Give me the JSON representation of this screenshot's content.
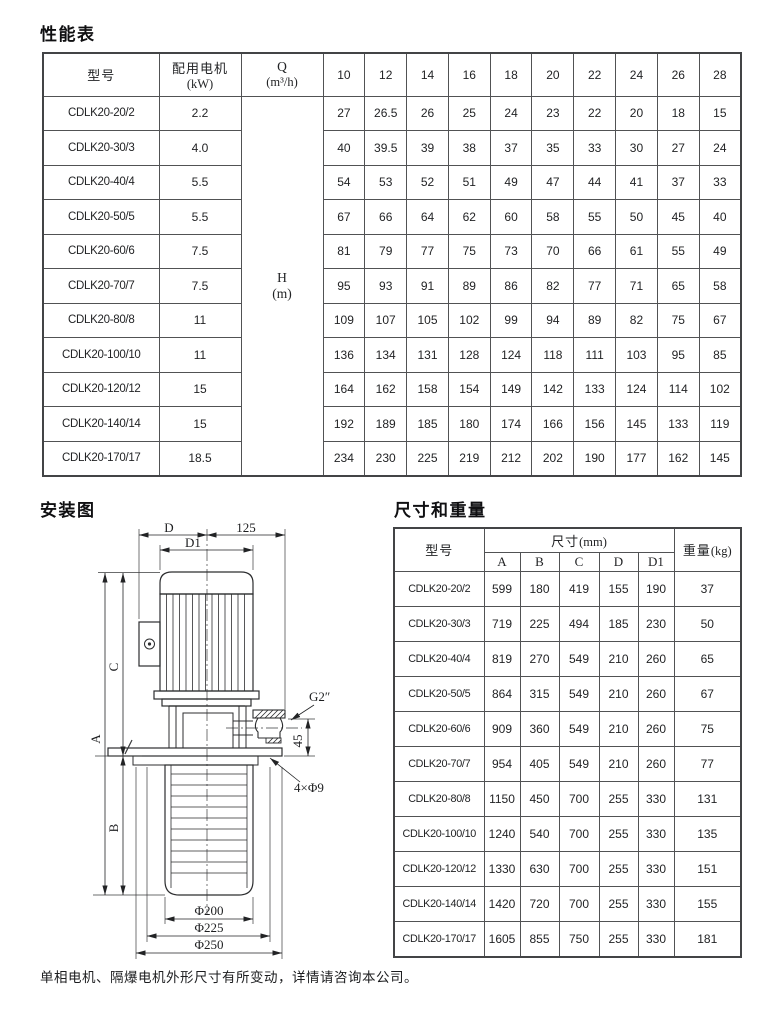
{
  "page": {
    "performance_title": "性能表",
    "installation_title": "安装图",
    "dimensions_title": "尺寸和重量",
    "footer_note": "单相电机、隔爆电机外形尺寸有所变动，详情请咨询本公司。"
  },
  "performance_table": {
    "col_model": "型号",
    "col_motor": "配用电机",
    "col_motor_unit": "(kW)",
    "col_q": "Q",
    "col_q_unit": "(m³/h)",
    "h_label": "H",
    "h_unit": "(m)",
    "flow_headers": [
      "10",
      "12",
      "14",
      "16",
      "18",
      "20",
      "22",
      "24",
      "26",
      "28"
    ],
    "rows": [
      {
        "model": "CDLK20-20/2",
        "kw": "2.2",
        "h": [
          "27",
          "26.5",
          "26",
          "25",
          "24",
          "23",
          "22",
          "20",
          "18",
          "15"
        ]
      },
      {
        "model": "CDLK20-30/3",
        "kw": "4.0",
        "h": [
          "40",
          "39.5",
          "39",
          "38",
          "37",
          "35",
          "33",
          "30",
          "27",
          "24"
        ]
      },
      {
        "model": "CDLK20-40/4",
        "kw": "5.5",
        "h": [
          "54",
          "53",
          "52",
          "51",
          "49",
          "47",
          "44",
          "41",
          "37",
          "33"
        ]
      },
      {
        "model": "CDLK20-50/5",
        "kw": "5.5",
        "h": [
          "67",
          "66",
          "64",
          "62",
          "60",
          "58",
          "55",
          "50",
          "45",
          "40"
        ]
      },
      {
        "model": "CDLK20-60/6",
        "kw": "7.5",
        "h": [
          "81",
          "79",
          "77",
          "75",
          "73",
          "70",
          "66",
          "61",
          "55",
          "49"
        ]
      },
      {
        "model": "CDLK20-70/7",
        "kw": "7.5",
        "h": [
          "95",
          "93",
          "91",
          "89",
          "86",
          "82",
          "77",
          "71",
          "65",
          "58"
        ]
      },
      {
        "model": "CDLK20-80/8",
        "kw": "11",
        "h": [
          "109",
          "107",
          "105",
          "102",
          "99",
          "94",
          "89",
          "82",
          "75",
          "67"
        ]
      },
      {
        "model": "CDLK20-100/10",
        "kw": "11",
        "h": [
          "136",
          "134",
          "131",
          "128",
          "124",
          "118",
          "111",
          "103",
          "95",
          "85"
        ]
      },
      {
        "model": "CDLK20-120/12",
        "kw": "15",
        "h": [
          "164",
          "162",
          "158",
          "154",
          "149",
          "142",
          "133",
          "124",
          "114",
          "102"
        ]
      },
      {
        "model": "CDLK20-140/14",
        "kw": "15",
        "h": [
          "192",
          "189",
          "185",
          "180",
          "174",
          "166",
          "156",
          "145",
          "133",
          "119"
        ]
      },
      {
        "model": "CDLK20-170/17",
        "kw": "18.5",
        "h": [
          "234",
          "230",
          "225",
          "219",
          "212",
          "202",
          "190",
          "177",
          "162",
          "145"
        ]
      }
    ]
  },
  "dimension_table": {
    "col_model": "型号",
    "col_dims": "尺寸",
    "col_dims_unit": "(mm)",
    "col_weight": "重量",
    "col_weight_unit": "(kg)",
    "dim_headers": [
      "A",
      "B",
      "C",
      "D",
      "D1"
    ],
    "rows": [
      {
        "model": "CDLK20-20/2",
        "dims": [
          "599",
          "180",
          "419",
          "155",
          "190"
        ],
        "weight": "37"
      },
      {
        "model": "CDLK20-30/3",
        "dims": [
          "719",
          "225",
          "494",
          "185",
          "230"
        ],
        "weight": "50"
      },
      {
        "model": "CDLK20-40/4",
        "dims": [
          "819",
          "270",
          "549",
          "210",
          "260"
        ],
        "weight": "65"
      },
      {
        "model": "CDLK20-50/5",
        "dims": [
          "864",
          "315",
          "549",
          "210",
          "260"
        ],
        "weight": "67"
      },
      {
        "model": "CDLK20-60/6",
        "dims": [
          "909",
          "360",
          "549",
          "210",
          "260"
        ],
        "weight": "75"
      },
      {
        "model": "CDLK20-70/7",
        "dims": [
          "954",
          "405",
          "549",
          "210",
          "260"
        ],
        "weight": "77"
      },
      {
        "model": "CDLK20-80/8",
        "dims": [
          "1150",
          "450",
          "700",
          "255",
          "330"
        ],
        "weight": "131"
      },
      {
        "model": "CDLK20-100/10",
        "dims": [
          "1240",
          "540",
          "700",
          "255",
          "330"
        ],
        "weight": "135"
      },
      {
        "model": "CDLK20-120/12",
        "dims": [
          "1330",
          "630",
          "700",
          "255",
          "330"
        ],
        "weight": "151"
      },
      {
        "model": "CDLK20-140/14",
        "dims": [
          "1420",
          "720",
          "700",
          "255",
          "330"
        ],
        "weight": "155"
      },
      {
        "model": "CDLK20-170/17",
        "dims": [
          "1605",
          "855",
          "750",
          "255",
          "330"
        ],
        "weight": "181"
      }
    ]
  },
  "diagram": {
    "labels": {
      "d": "D",
      "dim125": "125",
      "d1": "D1",
      "a": "A",
      "c": "C",
      "b": "B",
      "g2": "G2″",
      "dim45": "45",
      "holes": "4×Φ9",
      "phi200": "Φ200",
      "phi225": "Φ225",
      "phi250": "Φ250"
    }
  }
}
